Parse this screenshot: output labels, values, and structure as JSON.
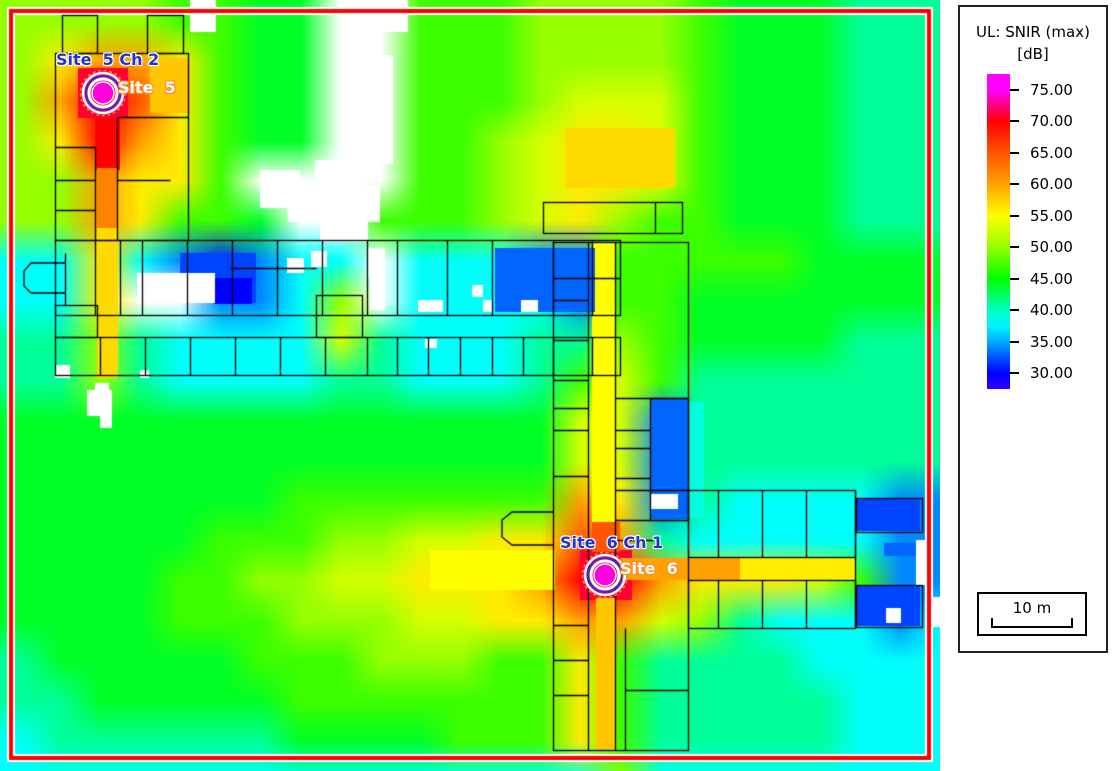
{
  "legend": {
    "title_line1": "UL: SNIR (max)",
    "title_line2": "[dB]",
    "tick_values": [
      "75.00",
      "70.00",
      "65.00",
      "60.00",
      "55.00",
      "50.00",
      "45.00",
      "40.00",
      "35.00",
      "30.00"
    ],
    "tick_numbers": [
      75,
      70,
      65,
      60,
      55,
      50,
      45,
      40,
      35,
      30
    ],
    "scale_bar_label": "10 m"
  },
  "sites": [
    {
      "name": "Site  5",
      "channel_label": "Site  5 Ch 2",
      "x": 103,
      "y": 93,
      "name_pos": [
        118,
        80
      ],
      "channel_pos": [
        56,
        52
      ]
    },
    {
      "name": "Site  6",
      "channel_label": "Site  6 Ch 1",
      "x": 605,
      "y": 575,
      "name_pos": [
        620,
        561
      ],
      "channel_pos": [
        560,
        535
      ]
    }
  ],
  "colors": {
    "border_red": "#ff0000",
    "border_white": "#ffffff",
    "label_blue": "#2433cf",
    "site_name_outline": "#ff8c28",
    "marker_fill": "#ff00dd",
    "marker_blue_ring": "#2233ee",
    "marker_orange_ring": "#ff7733",
    "plan_line": "#000000"
  },
  "chart_data": {
    "type": "heatmap",
    "title": "UL: SNIR (max) [dB]",
    "units": "dB",
    "value_range": [
      30,
      75
    ],
    "legend_position": "right",
    "colormap_anchors": [
      [
        27.5,
        252
      ],
      [
        30,
        240
      ],
      [
        35,
        200
      ],
      [
        40,
        165
      ],
      [
        45,
        120
      ],
      [
        50,
        85
      ],
      [
        55,
        60
      ],
      [
        60,
        38
      ],
      [
        65,
        20
      ],
      [
        70,
        0
      ],
      [
        75,
        -60
      ],
      [
        78,
        -60
      ]
    ],
    "cell_size_px": 40,
    "value_key": {
      "B": 31,
      "b": 34,
      "c": 38,
      "t": 41,
      "e": 44,
      "g": 47,
      "G": 50,
      "Y": 53,
      "y": 56,
      "o": 60,
      "O": 65,
      "r": 70,
      "m": 75,
      "W": "no-data"
    },
    "grid_rows": [
      "GGGGggeeWWgggGGGGgeeettt",
      "GyooygeeWWgggGGGGgeeettt",
      "GorOygeeWWgggGYYYgeeettt",
      "GyroygeeWWggGYyyYgeeettt",
      "GGoyygWWWWggGYyyYgeeettt",
      "GGoyggeWWgggGYyGggeeettt",
      "ccycbBbccWcccbbgggggeeee",
      "ccyWWbbcGWccccbggeeeeeee",
      "ttGtccccYtcccttGgeeeettt",
      "ttGtccccttccctgYgttttttt",
      "eeeeeeeeeeeeeeYYbttttttt",
      "eeeeeeeeeeeeeeYYbttttttt",
      "eeeeeeegggggggoybtccccbb",
      "eeeeegggGGYYyyOotcccccbb",
      "eeeeggGGYYyyyorroyyyYgbb",
      "eeeegggGGGYYyyooYGtcccbc",
      "teeeeegggGGGggygttttcccc",
      "tteeeeegggggggygtttttccc",
      "ctttttteeeegggygtttttccc",
      "cccccccccccccccGcccccccc"
    ],
    "overlays": [
      [
        78,
        68,
        50,
        50,
        71
      ],
      [
        95,
        118,
        25,
        52,
        70
      ],
      [
        97,
        168,
        21,
        62,
        62
      ],
      [
        97,
        228,
        21,
        150,
        57
      ],
      [
        150,
        58,
        40,
        55,
        58
      ],
      [
        580,
        550,
        52,
        50,
        71
      ],
      [
        592,
        522,
        28,
        30,
        65
      ],
      [
        596,
        598,
        20,
        152,
        58
      ],
      [
        592,
        242,
        24,
        280,
        55
      ],
      [
        620,
        558,
        120,
        22,
        60
      ],
      [
        740,
        558,
        116,
        22,
        56
      ],
      [
        430,
        550,
        125,
        40,
        55
      ],
      [
        565,
        128,
        110,
        60,
        57
      ],
      [
        180,
        253,
        76,
        50,
        32
      ],
      [
        214,
        278,
        38,
        26,
        30
      ],
      [
        495,
        248,
        100,
        64,
        33
      ],
      [
        650,
        399,
        38,
        120,
        33
      ],
      [
        688,
        402,
        16,
        116,
        39
      ],
      [
        856,
        498,
        64,
        33,
        32
      ],
      [
        856,
        585,
        64,
        41,
        32
      ],
      [
        884,
        543,
        37,
        13,
        33
      ]
    ],
    "nodata_rects": [
      [
        190,
        0,
        26,
        32
      ],
      [
        340,
        0,
        42,
        58
      ],
      [
        380,
        0,
        28,
        32
      ],
      [
        341,
        55,
        52,
        78
      ],
      [
        352,
        130,
        41,
        34
      ],
      [
        315,
        160,
        50,
        28
      ],
      [
        303,
        186,
        77,
        36
      ],
      [
        320,
        220,
        48,
        22
      ],
      [
        260,
        170,
        40,
        38
      ],
      [
        288,
        206,
        16,
        16
      ],
      [
        137,
        273,
        78,
        30
      ],
      [
        287,
        258,
        17,
        15
      ],
      [
        311,
        251,
        16,
        16
      ],
      [
        368,
        248,
        17,
        30
      ],
      [
        370,
        278,
        15,
        32
      ],
      [
        418,
        300,
        25,
        12
      ],
      [
        472,
        285,
        11,
        12
      ],
      [
        483,
        300,
        10,
        12
      ],
      [
        521,
        300,
        17,
        12
      ],
      [
        425,
        339,
        12,
        9
      ],
      [
        140,
        370,
        9,
        8
      ],
      [
        55,
        365,
        15,
        13
      ],
      [
        95,
        383,
        14,
        7
      ],
      [
        87,
        390,
        25,
        26
      ],
      [
        100,
        414,
        12,
        14
      ],
      [
        651,
        494,
        27,
        15
      ],
      [
        886,
        608,
        15,
        15
      ],
      [
        916,
        540,
        11,
        45
      ],
      [
        933,
        597,
        7,
        30
      ]
    ]
  },
  "floorplan": {
    "rects": [
      [
        55,
        53,
        133,
        187
      ],
      [
        62,
        15,
        35,
        38
      ],
      [
        147,
        15,
        36,
        38
      ],
      [
        55,
        240,
        565,
        75
      ],
      [
        55,
        337,
        565,
        38
      ],
      [
        543,
        202,
        139,
        31
      ],
      [
        553,
        242,
        135,
        508
      ],
      [
        650,
        398,
        38,
        122
      ],
      [
        688,
        490,
        167,
        67
      ],
      [
        688,
        580,
        167,
        48
      ],
      [
        856,
        498,
        66,
        34
      ],
      [
        856,
        585,
        66,
        42
      ],
      [
        55,
        305,
        42,
        32
      ],
      [
        316,
        295,
        46,
        42
      ]
    ],
    "lines": [
      [
        117,
        117,
        117,
        240
      ],
      [
        117,
        117,
        188,
        117
      ],
      [
        55,
        147,
        95,
        147
      ],
      [
        55,
        180,
        95,
        180
      ],
      [
        55,
        210,
        95,
        210
      ],
      [
        95,
        147,
        95,
        240
      ],
      [
        117,
        180,
        170,
        180
      ],
      [
        95,
        240,
        95,
        315
      ],
      [
        120,
        240,
        120,
        315
      ],
      [
        142,
        240,
        142,
        315
      ],
      [
        187,
        240,
        187,
        315
      ],
      [
        232,
        240,
        232,
        315
      ],
      [
        277,
        240,
        277,
        315
      ],
      [
        322,
        240,
        322,
        315
      ],
      [
        367,
        240,
        367,
        315
      ],
      [
        397,
        240,
        397,
        315
      ],
      [
        447,
        240,
        447,
        315
      ],
      [
        492,
        240,
        492,
        315
      ],
      [
        553,
        240,
        553,
        315
      ],
      [
        592,
        240,
        592,
        315
      ],
      [
        230,
        268,
        316,
        268
      ],
      [
        553,
        278,
        620,
        278
      ],
      [
        100,
        337,
        100,
        375
      ],
      [
        145,
        337,
        145,
        375
      ],
      [
        190,
        337,
        190,
        375
      ],
      [
        235,
        337,
        235,
        375
      ],
      [
        280,
        337,
        280,
        375
      ],
      [
        325,
        337,
        325,
        375
      ],
      [
        367,
        337,
        367,
        375
      ],
      [
        397,
        337,
        397,
        375
      ],
      [
        428,
        337,
        428,
        375
      ],
      [
        460,
        337,
        460,
        375
      ],
      [
        492,
        337,
        492,
        375
      ],
      [
        523,
        337,
        523,
        375
      ],
      [
        553,
        337,
        553,
        375
      ],
      [
        592,
        337,
        592,
        375
      ],
      [
        655,
        202,
        655,
        233
      ],
      [
        588,
        242,
        588,
        750
      ],
      [
        615,
        242,
        615,
        750
      ],
      [
        553,
        300,
        588,
        300
      ],
      [
        553,
        340,
        588,
        340
      ],
      [
        553,
        380,
        588,
        380
      ],
      [
        553,
        408,
        588,
        408
      ],
      [
        553,
        430,
        588,
        430
      ],
      [
        553,
        476,
        588,
        476
      ],
      [
        553,
        625,
        588,
        625
      ],
      [
        553,
        660,
        588,
        660
      ],
      [
        553,
        695,
        588,
        695
      ],
      [
        615,
        398,
        688,
        398
      ],
      [
        615,
        430,
        650,
        430
      ],
      [
        615,
        448,
        650,
        448
      ],
      [
        615,
        478,
        650,
        478
      ],
      [
        615,
        520,
        688,
        520
      ],
      [
        615,
        490,
        688,
        490
      ],
      [
        615,
        540,
        653,
        540
      ],
      [
        625,
        628,
        625,
        750
      ],
      [
        625,
        690,
        688,
        690
      ],
      [
        718,
        490,
        718,
        557
      ],
      [
        762,
        490,
        762,
        557
      ],
      [
        806,
        490,
        806,
        557
      ],
      [
        718,
        580,
        718,
        628
      ],
      [
        762,
        580,
        762,
        628
      ],
      [
        806,
        580,
        806,
        628
      ],
      [
        855,
        490,
        855,
        628
      ],
      [
        65,
        253,
        65,
        305
      ]
    ],
    "paths": [
      "M65,263 L31,263 L24,271 L24,286 L31,293 L65,293",
      "M553,512 L512,512 L502,520 L502,537 L512,545 L553,545"
    ]
  }
}
